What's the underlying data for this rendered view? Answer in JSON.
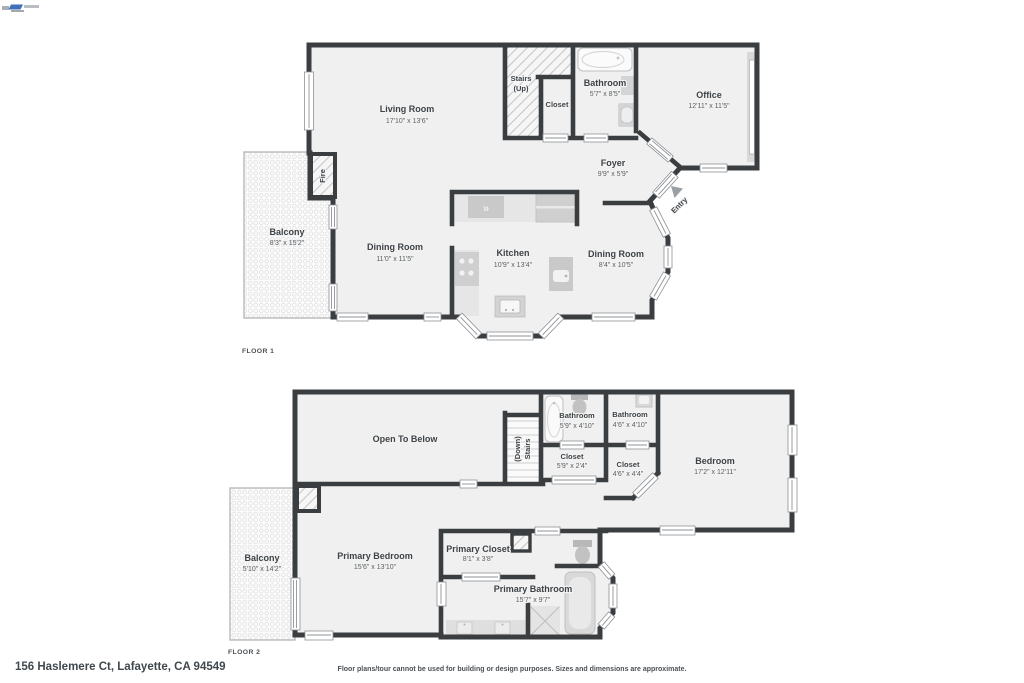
{
  "page": {
    "address": "156 Haslemere Ct, Lafayette, CA 94549",
    "disclaimer": "Floor plans/tour cannot be used for building or design purposes. Sizes and dimensions are approximate."
  },
  "floor1": {
    "label": "FLOOR 1",
    "rooms": {
      "living": {
        "name": "Living Room",
        "dims": "17'10\" x 13'6\""
      },
      "stairs": {
        "name": "Stairs",
        "sub": "(Up)"
      },
      "closet": {
        "name": "Closet"
      },
      "bathroom": {
        "name": "Bathroom",
        "dims": "5'7\" x 8'5\""
      },
      "office": {
        "name": "Office",
        "dims": "12'11\" x 11'5\""
      },
      "foyer": {
        "name": "Foyer",
        "dims": "9'9\" x 5'9\""
      },
      "balcony": {
        "name": "Balcony",
        "dims": "8'3\" x 15'2\""
      },
      "fire": {
        "name": "Fire"
      },
      "dining1": {
        "name": "Dining Room",
        "dims": "11'0\" x 11'5\""
      },
      "kitchen": {
        "name": "Kitchen",
        "dims": "10'9\" x 13'4\""
      },
      "dining2": {
        "name": "Dining Room",
        "dims": "8'4\" x 10'5\""
      },
      "entry": {
        "name": "Entry"
      }
    }
  },
  "floor2": {
    "label": "FLOOR 2",
    "rooms": {
      "open_below": {
        "name": "Open To Below"
      },
      "stairs": {
        "name": "Stairs",
        "sub": "(Down)"
      },
      "bathroom1": {
        "name": "Bathroom",
        "dims": "5'9\" x 4'10\""
      },
      "bathroom2": {
        "name": "Bathroom",
        "dims": "4'6\" x 4'10\""
      },
      "closet1": {
        "name": "Closet",
        "dims": "5'9\" x 2'4\""
      },
      "closet2": {
        "name": "Closet",
        "dims": "4'6\" x 4'4\""
      },
      "bedroom": {
        "name": "Bedroom",
        "dims": "17'2\" x 12'11\""
      },
      "balcony": {
        "name": "Balcony",
        "dims": "5'10\" x 14'2\""
      },
      "primary_bedroom": {
        "name": "Primary Bedroom",
        "dims": "15'6\" x 13'10\""
      },
      "primary_closet": {
        "name": "Primary Closet",
        "dims": "8'1\" x 3'8\""
      },
      "primary_bathroom": {
        "name": "Primary Bathroom",
        "dims": "15'7\" x 9'7\""
      }
    }
  }
}
